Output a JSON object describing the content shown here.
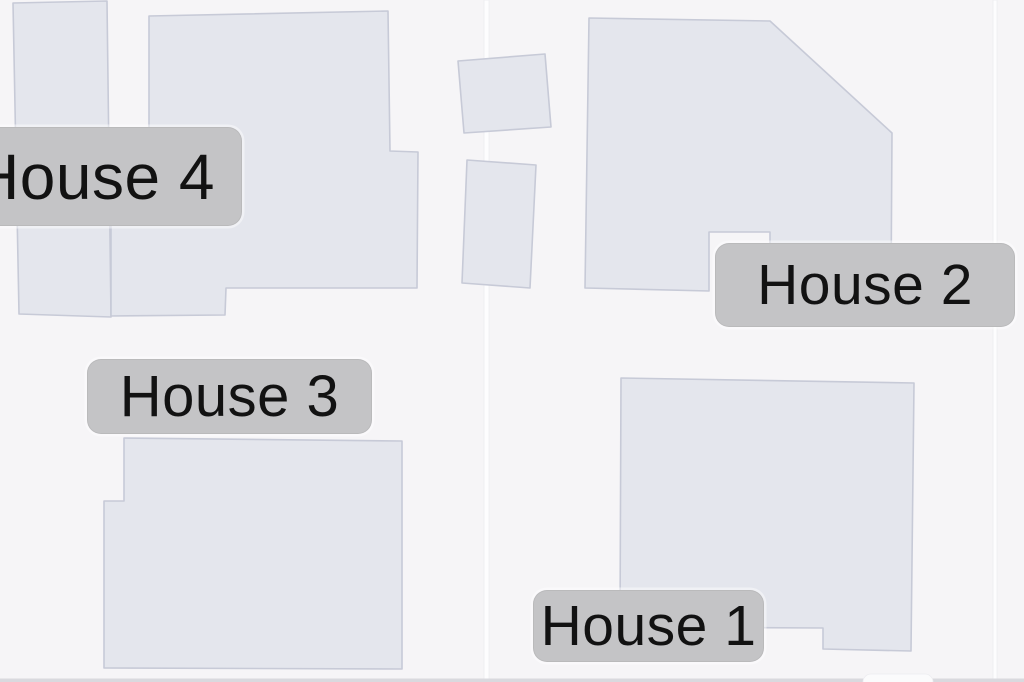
{
  "map_type": "building-footprint-map",
  "colors": {
    "background": "#f6f5f7",
    "building_fill": "#e4e6ed",
    "building_stroke": "#c7cad7",
    "road": "#fdfdfe",
    "road_edge": "#ececf0",
    "label_bg": "#c4c4c6",
    "label_text": "#121212",
    "bottom_strip": "#d9d9de",
    "partial_bubble": "#fbfbfc"
  },
  "labels": [
    {
      "id": "house-4",
      "text": "House 4",
      "x": -54,
      "y": 127,
      "w": 296,
      "h": 99,
      "font_px": 64
    },
    {
      "id": "house-2",
      "text": "House 2",
      "x": 715,
      "y": 243,
      "w": 300,
      "h": 84,
      "font_px": 57
    },
    {
      "id": "house-3",
      "text": "House 3",
      "x": 87,
      "y": 359,
      "w": 285,
      "h": 75,
      "font_px": 58
    },
    {
      "id": "house-1",
      "text": "House 1",
      "x": 533,
      "y": 590,
      "w": 231,
      "h": 72,
      "font_px": 57
    }
  ],
  "buildings": [
    {
      "id": "house-4-annex",
      "points": "13,3 107,1 111,317 19,314"
    },
    {
      "id": "house-4-main",
      "points": "149,16 388,11 390,151 418,152 417,288 226,288 225,315 111,316 111,140 149,140"
    },
    {
      "id": "outbuilding-upper",
      "points": "458,61 545,54 551,127 464,133"
    },
    {
      "id": "outbuilding-lower",
      "points": "467,160 536,165 530,288 462,283"
    },
    {
      "id": "house-2-main",
      "points": "589,18 770,21 892,133 891,293 770,290 770,232 709,232 709,291 585,288"
    },
    {
      "id": "house-1-main",
      "points": "621,378 914,383 911,651 823,649 823,628 620,627"
    },
    {
      "id": "house-3-main",
      "points": "124,438 402,441 402,669 104,668 104,501 124,501"
    }
  ],
  "roads": [
    {
      "id": "road-vertical-left",
      "x": 484,
      "width": 5
    },
    {
      "id": "road-vertical-right",
      "x": 993,
      "width": 4
    }
  ],
  "decor": {
    "edge_strip": {
      "y": 678.5,
      "height": 3.5
    },
    "partial_bubble": {
      "x": 863,
      "y": 674,
      "w": 70,
      "h": 16,
      "rx": 8
    }
  }
}
